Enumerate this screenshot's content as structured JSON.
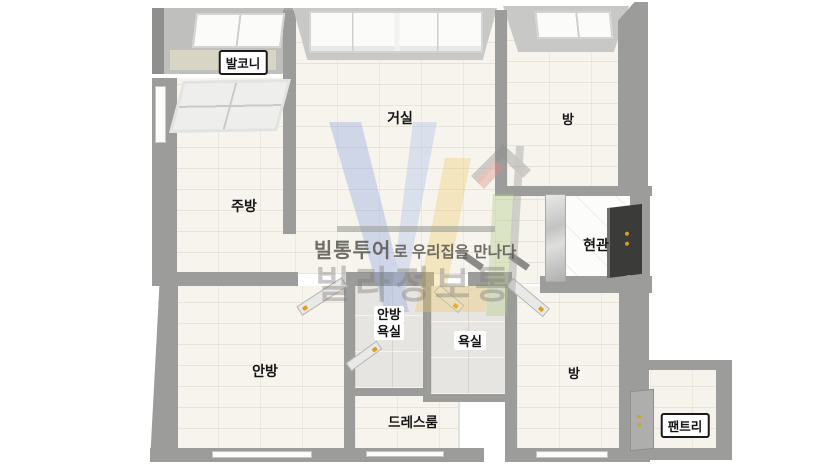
{
  "floorplan": {
    "rooms": [
      {
        "id": "balcony",
        "label": "발코니"
      },
      {
        "id": "living-room",
        "label": "거실"
      },
      {
        "id": "room-top-right",
        "label": "방"
      },
      {
        "id": "kitchen",
        "label": "주방"
      },
      {
        "id": "entrance",
        "label": "현관"
      },
      {
        "id": "master-bedroom",
        "label": "안방"
      },
      {
        "id": "master-bathroom",
        "lines": [
          "안방",
          "욕실"
        ]
      },
      {
        "id": "bathroom",
        "label": "욕실"
      },
      {
        "id": "room-bottom-right",
        "label": "방"
      },
      {
        "id": "dress-room",
        "label": "드레스룸"
      },
      {
        "id": "pantry",
        "label": "팬트리"
      }
    ]
  },
  "watermark": {
    "logo_text": "VL",
    "tagline_bold": "빌통투어",
    "tagline_rest": "로 우리집을 만나다",
    "brand_name": "빌라정보통"
  },
  "colors": {
    "wall": "#9c9c9a",
    "wall_light": "#c8c8c6",
    "floor": "#f6f4ec",
    "bathroom_floor": "#e7e5e1",
    "entrance_floor": "#fcfcfb",
    "front_door": "#3b3b39",
    "door_handle_gold": "#d8a01f",
    "logo_blue": "#8fa6dd",
    "logo_yellow": "#ecc96b",
    "logo_red": "#dc8f88",
    "logo_green": "#b5cd8e",
    "watermark_text": "#807e7a"
  }
}
